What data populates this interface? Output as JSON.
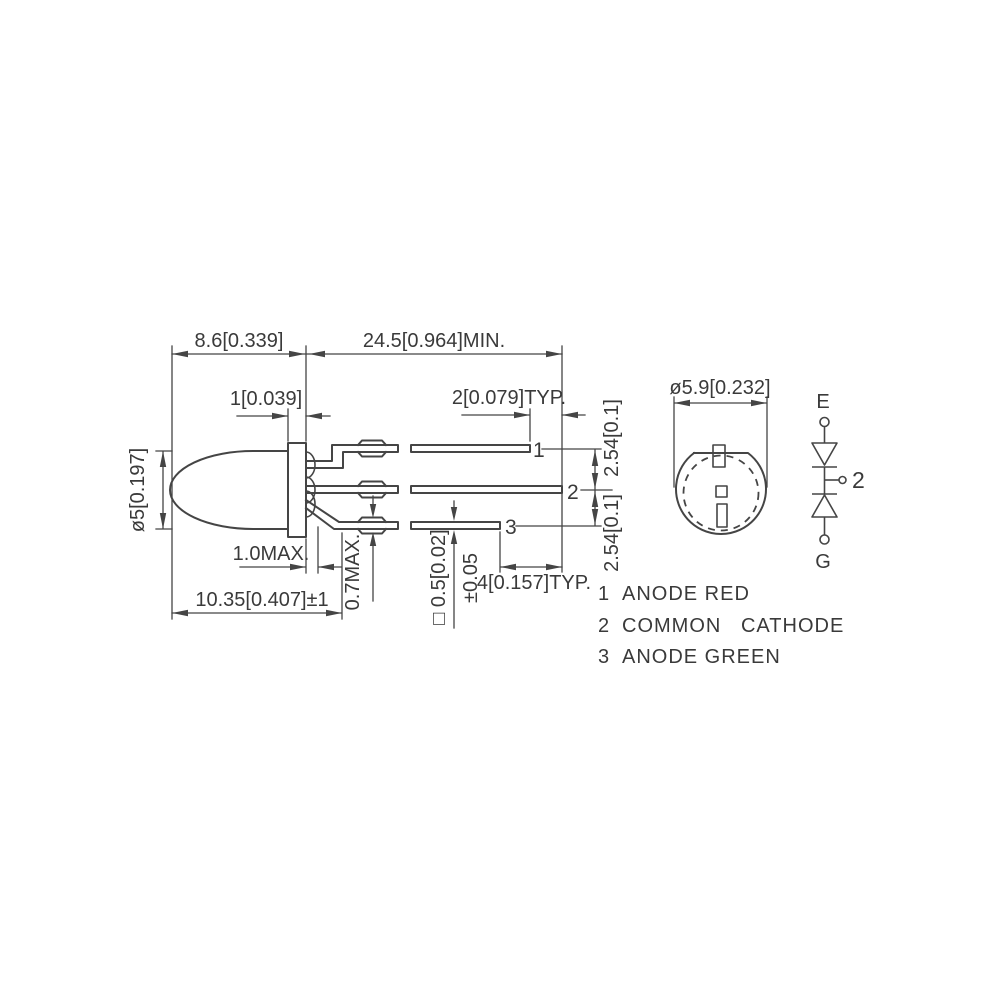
{
  "colors": {
    "line": "#454545",
    "text": "#3a3a3a",
    "background": "#ffffff"
  },
  "side_view": {
    "dim_body_length": "8.6[0.339]",
    "dim_lead_length": "24.5[0.964]MIN.",
    "dim_flange_thickness": "1[0.039]",
    "dim_tip_stagger": "2[0.079]TYP.",
    "dim_body_diameter": "ø5[0.197]",
    "dim_standoff": "1.0MAX.",
    "dim_crimp_thickness": "0.7MAX.",
    "dim_overall_length": "10.35[0.407]±1",
    "dim_lead_section": "□ 0.5[0.02]",
    "dim_lead_section_tolerance": "±0.05",
    "dim_pitch_upper": "2.54[0.1]",
    "dim_pitch_lower": "2.54[0.1]",
    "dim_tip_span": "4[0.157]TYP.",
    "lead_numbers": [
      "1",
      "2",
      "3"
    ]
  },
  "top_view": {
    "dim_flange_diameter": "ø5.9[0.232]"
  },
  "schematic": {
    "terminal_top_label": "E",
    "terminal_bottom_label": "G",
    "common_pin_label": "2"
  },
  "legend": {
    "items": [
      {
        "num": "1",
        "label": "ANODE RED"
      },
      {
        "num": "2",
        "label": "COMMON   CATHODE"
      },
      {
        "num": "3",
        "label": "ANODE GREEN"
      }
    ]
  }
}
